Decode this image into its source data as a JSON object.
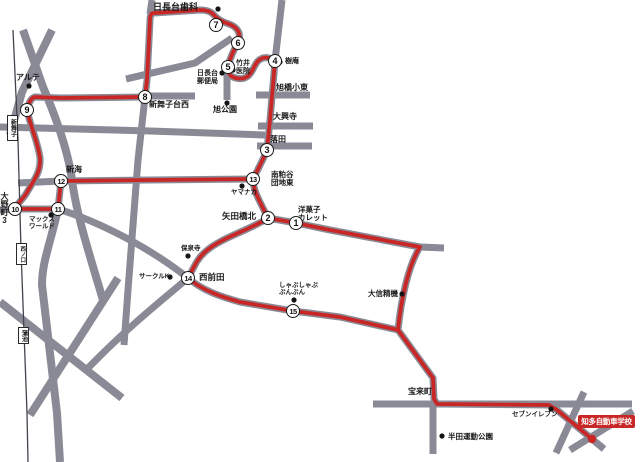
{
  "map": {
    "colors": {
      "route": "#c92626",
      "road": "#8a8a96",
      "rail": "#43434d",
      "dot": "#141414"
    },
    "stops": [
      "1",
      "2",
      "3",
      "4",
      "5",
      "6",
      "7",
      "8",
      "9",
      "10",
      "11",
      "12",
      "13",
      "14",
      "15"
    ],
    "stations": [
      "新舞子",
      "西ノ口",
      "蒲池"
    ],
    "labels": {
      "dental": "日長台歯科",
      "takei": [
        "竹井",
        "医院"
      ],
      "juan": "樹庵",
      "post": [
        "日長台",
        "郵便局"
      ],
      "asahibashi": "旭橋小東",
      "asahi_park": "旭公園",
      "daikoji": "大興寺",
      "ochida": "落田",
      "shinmaiko_nishi": "新舞子台西",
      "arute": "アルテ",
      "onocho3": "大野町3",
      "shinkai": "新海",
      "max_world": [
        "マックス",
        "ワールド"
      ],
      "minami_kasuya": [
        "南粕谷",
        "団地東"
      ],
      "yamanaka": "ヤマナカ",
      "yadabashi": "矢田橋北",
      "calette": [
        "洋菓子",
        "カレット"
      ],
      "hosenji": "保泉寺",
      "circle_k": "サークルK",
      "nishi_maeda": "西前田",
      "bunbun": [
        "しゃぶしゃぶ",
        "ぶんぶん"
      ],
      "daishin": "大信精機",
      "horaicho": "宝来町",
      "seven": "セブンイレブン",
      "handa_park": "半田運動公園",
      "school": "知多自動車学校"
    }
  }
}
